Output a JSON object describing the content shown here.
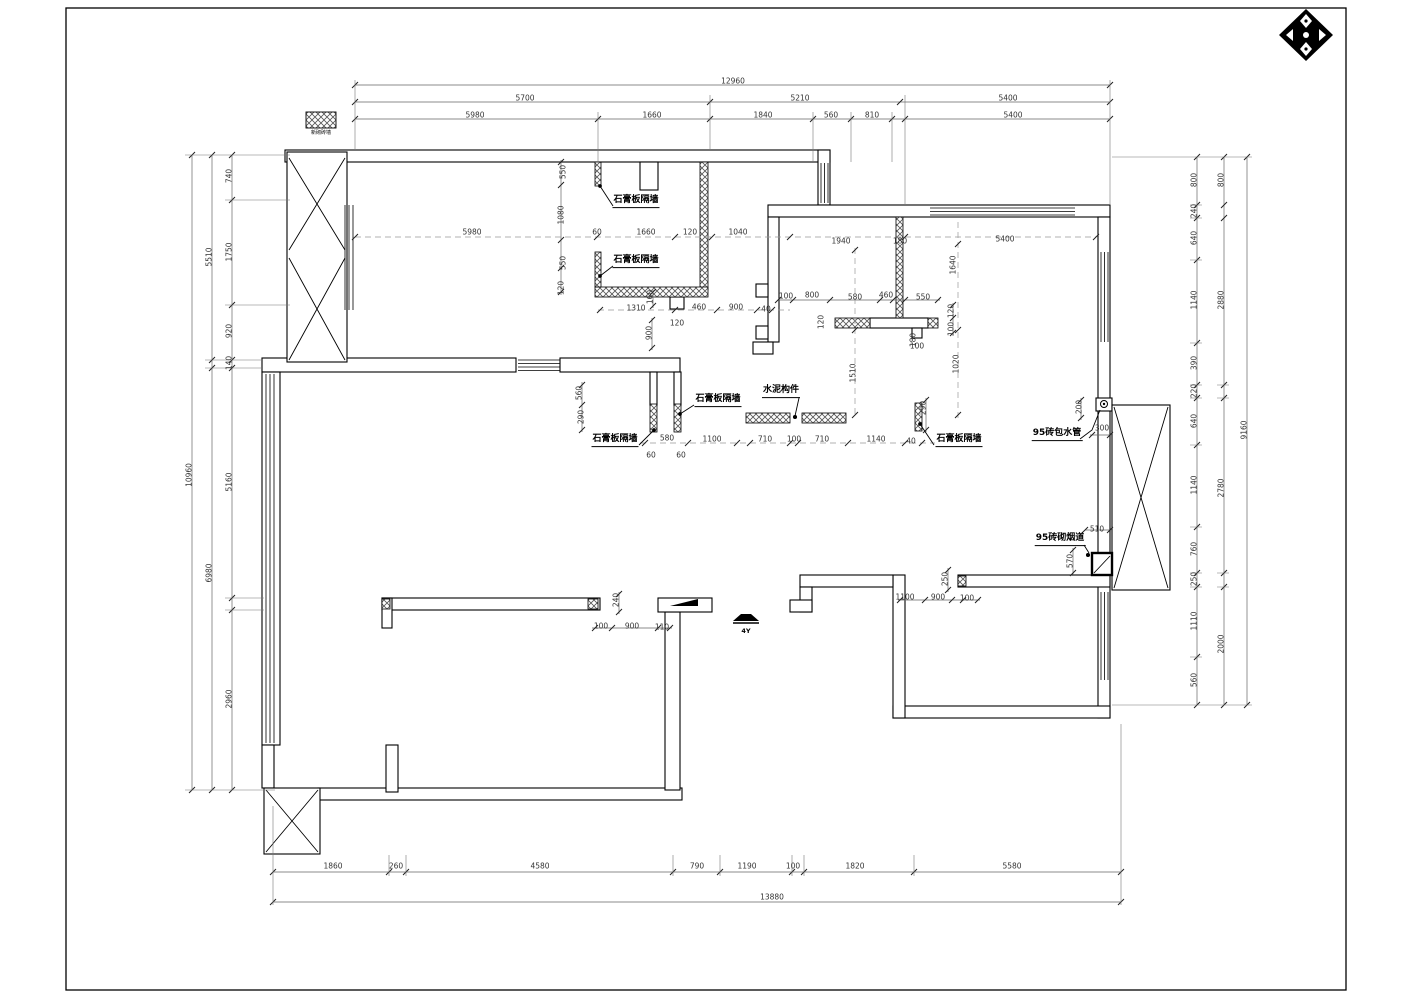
{
  "page": {
    "background": "#ffffff",
    "line_color": "#000000",
    "dim_color": "#3a3a3a",
    "dashed_color": "#999999"
  },
  "legend": {
    "caption": "新砌砖墙"
  },
  "markers": {
    "section_text": "4Y"
  },
  "callouts": [
    {
      "text": "石膏板隔墙",
      "x": 636,
      "y": 208
    },
    {
      "text": "石膏板隔墙",
      "x": 636,
      "y": 268
    },
    {
      "text": "石膏板隔墙",
      "x": 615,
      "y": 447
    },
    {
      "text": "石膏板隔墙",
      "x": 718,
      "y": 407
    },
    {
      "text": "石膏板隔墙",
      "x": 959,
      "y": 447
    },
    {
      "text": "水泥构件",
      "x": 781,
      "y": 398
    },
    {
      "text": "95砖包水管",
      "x": 1057,
      "y": 441
    },
    {
      "text": "95砖砌烟道",
      "x": 1060,
      "y": 546
    }
  ],
  "dimensions": [
    {
      "t": "12960",
      "x": 733,
      "y": 81
    },
    {
      "t": "5700",
      "x": 525,
      "y": 98
    },
    {
      "t": "5210",
      "x": 800,
      "y": 98
    },
    {
      "t": "5400",
      "x": 1008,
      "y": 98
    },
    {
      "t": "5980",
      "x": 475,
      "y": 115
    },
    {
      "t": "1660",
      "x": 652,
      "y": 115
    },
    {
      "t": "1840",
      "x": 763,
      "y": 115
    },
    {
      "t": "560",
      "x": 831,
      "y": 115
    },
    {
      "t": "810",
      "x": 872,
      "y": 115
    },
    {
      "t": "5400",
      "x": 1013,
      "y": 115
    },
    {
      "t": "550",
      "x": 563,
      "y": 172,
      "r": 90
    },
    {
      "t": "1080",
      "x": 561,
      "y": 215,
      "r": 90
    },
    {
      "t": "550",
      "x": 563,
      "y": 263,
      "r": 90
    },
    {
      "t": "120",
      "x": 561,
      "y": 288,
      "r": 90
    },
    {
      "t": "5980",
      "x": 472,
      "y": 232
    },
    {
      "t": "60",
      "x": 597,
      "y": 232
    },
    {
      "t": "1660",
      "x": 646,
      "y": 232
    },
    {
      "t": "120",
      "x": 690,
      "y": 232
    },
    {
      "t": "1040",
      "x": 738,
      "y": 232
    },
    {
      "t": "1940",
      "x": 841,
      "y": 241
    },
    {
      "t": "180",
      "x": 900,
      "y": 241
    },
    {
      "t": "5400",
      "x": 1005,
      "y": 239
    },
    {
      "t": "1640",
      "x": 953,
      "y": 265,
      "r": 90
    },
    {
      "t": "120",
      "x": 951,
      "y": 311,
      "r": 90
    },
    {
      "t": "100",
      "x": 951,
      "y": 329,
      "r": 90
    },
    {
      "t": "1020",
      "x": 956,
      "y": 364,
      "r": 90
    },
    {
      "t": "1510",
      "x": 853,
      "y": 373,
      "r": 90
    },
    {
      "t": "100",
      "x": 786,
      "y": 296
    },
    {
      "t": "800",
      "x": 812,
      "y": 295
    },
    {
      "t": "580",
      "x": 855,
      "y": 297
    },
    {
      "t": "460",
      "x": 886,
      "y": 295
    },
    {
      "t": "550",
      "x": 923,
      "y": 297
    },
    {
      "t": "120",
      "x": 821,
      "y": 322,
      "r": 90
    },
    {
      "t": "180",
      "x": 913,
      "y": 340,
      "r": 90
    },
    {
      "t": "100",
      "x": 917,
      "y": 346
    },
    {
      "t": "1310",
      "x": 636,
      "y": 308
    },
    {
      "t": "460",
      "x": 699,
      "y": 307
    },
    {
      "t": "900",
      "x": 736,
      "y": 307
    },
    {
      "t": "40",
      "x": 766,
      "y": 309
    },
    {
      "t": "120",
      "x": 677,
      "y": 323
    },
    {
      "t": "160",
      "x": 650,
      "y": 297,
      "r": 90
    },
    {
      "t": "900",
      "x": 649,
      "y": 333,
      "r": 90
    },
    {
      "t": "560",
      "x": 579,
      "y": 393,
      "r": 90
    },
    {
      "t": "290",
      "x": 581,
      "y": 417,
      "r": 90
    },
    {
      "t": "580",
      "x": 667,
      "y": 438
    },
    {
      "t": "60",
      "x": 651,
      "y": 455
    },
    {
      "t": "60",
      "x": 681,
      "y": 455
    },
    {
      "t": "1100",
      "x": 712,
      "y": 439
    },
    {
      "t": "710",
      "x": 765,
      "y": 439
    },
    {
      "t": "100",
      "x": 794,
      "y": 439
    },
    {
      "t": "710",
      "x": 822,
      "y": 439
    },
    {
      "t": "1140",
      "x": 876,
      "y": 439
    },
    {
      "t": "40",
      "x": 911,
      "y": 441
    },
    {
      "t": "290",
      "x": 923,
      "y": 408,
      "r": 90
    },
    {
      "t": "200",
      "x": 1079,
      "y": 407,
      "r": 90
    },
    {
      "t": "300",
      "x": 1102,
      "y": 428
    },
    {
      "t": "510",
      "x": 1097,
      "y": 529
    },
    {
      "t": "570",
      "x": 1070,
      "y": 561,
      "r": 90
    },
    {
      "t": "250",
      "x": 945,
      "y": 579,
      "r": 90
    },
    {
      "t": "1100",
      "x": 905,
      "y": 597
    },
    {
      "t": "900",
      "x": 938,
      "y": 597
    },
    {
      "t": "100",
      "x": 967,
      "y": 598
    },
    {
      "t": "240",
      "x": 616,
      "y": 600,
      "r": 90
    },
    {
      "t": "100",
      "x": 601,
      "y": 626
    },
    {
      "t": "900",
      "x": 632,
      "y": 626
    },
    {
      "t": "110",
      "x": 662,
      "y": 627
    },
    {
      "t": "1860",
      "x": 333,
      "y": 866
    },
    {
      "t": "260",
      "x": 396,
      "y": 866
    },
    {
      "t": "4580",
      "x": 540,
      "y": 866
    },
    {
      "t": "790",
      "x": 697,
      "y": 866
    },
    {
      "t": "1190",
      "x": 747,
      "y": 866
    },
    {
      "t": "100",
      "x": 793,
      "y": 866
    },
    {
      "t": "1820",
      "x": 855,
      "y": 866
    },
    {
      "t": "5580",
      "x": 1012,
      "y": 866
    },
    {
      "t": "13880",
      "x": 772,
      "y": 897
    },
    {
      "t": "10960",
      "x": 189,
      "y": 475,
      "r": 90
    },
    {
      "t": "5510",
      "x": 209,
      "y": 257,
      "r": 90
    },
    {
      "t": "6980",
      "x": 209,
      "y": 573,
      "r": 90
    },
    {
      "t": "740",
      "x": 229,
      "y": 176,
      "r": 90
    },
    {
      "t": "1750",
      "x": 229,
      "y": 252,
      "r": 90
    },
    {
      "t": "920",
      "x": 229,
      "y": 331,
      "r": 90
    },
    {
      "t": "140",
      "x": 229,
      "y": 363,
      "r": 90
    },
    {
      "t": "5160",
      "x": 229,
      "y": 482,
      "r": 90
    },
    {
      "t": "2960",
      "x": 229,
      "y": 699,
      "r": 90
    },
    {
      "t": "800",
      "x": 1194,
      "y": 180,
      "r": 90
    },
    {
      "t": "240",
      "x": 1194,
      "y": 211,
      "r": 90
    },
    {
      "t": "640",
      "x": 1194,
      "y": 238,
      "r": 90
    },
    {
      "t": "1140",
      "x": 1194,
      "y": 300,
      "r": 90
    },
    {
      "t": "390",
      "x": 1194,
      "y": 363,
      "r": 90
    },
    {
      "t": "220",
      "x": 1194,
      "y": 391,
      "r": 90
    },
    {
      "t": "640",
      "x": 1194,
      "y": 421,
      "r": 90
    },
    {
      "t": "1140",
      "x": 1194,
      "y": 485,
      "r": 90
    },
    {
      "t": "760",
      "x": 1194,
      "y": 549,
      "r": 90
    },
    {
      "t": "250",
      "x": 1194,
      "y": 579,
      "r": 90
    },
    {
      "t": "1110",
      "x": 1194,
      "y": 621,
      "r": 90
    },
    {
      "t": "560",
      "x": 1194,
      "y": 680,
      "r": 90
    },
    {
      "t": "800",
      "x": 1221,
      "y": 180,
      "r": 90
    },
    {
      "t": "2880",
      "x": 1221,
      "y": 300,
      "r": 90
    },
    {
      "t": "2780",
      "x": 1221,
      "y": 488,
      "r": 90
    },
    {
      "t": "2000",
      "x": 1221,
      "y": 644,
      "r": 90
    },
    {
      "t": "9160",
      "x": 1244,
      "y": 430,
      "r": 90
    }
  ]
}
